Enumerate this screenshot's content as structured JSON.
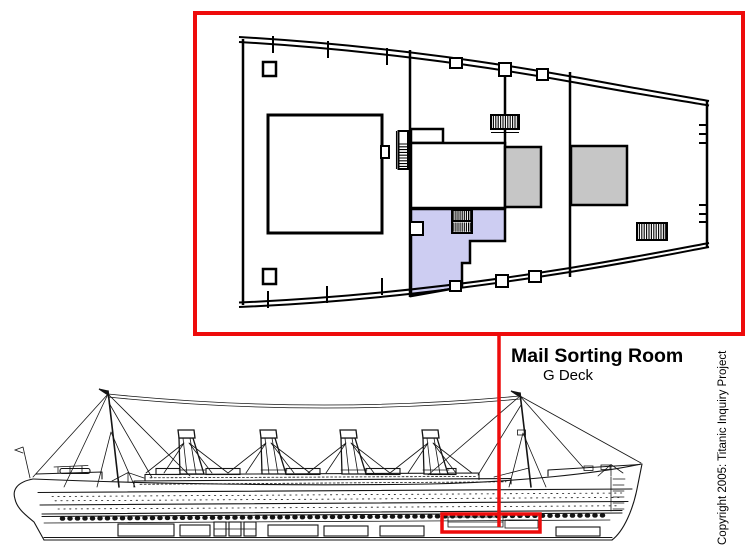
{
  "callout": {
    "title": "Mail Sorting Room",
    "subtitle": "G Deck"
  },
  "copyright_notice": "Copyright 2005: Titanic Inquiry Project",
  "colors": {
    "accent_red": "#ee0b0b",
    "highlight_blue": "#cdcdf2",
    "block_gray": "#c6c6c6",
    "ink": "#000000"
  }
}
